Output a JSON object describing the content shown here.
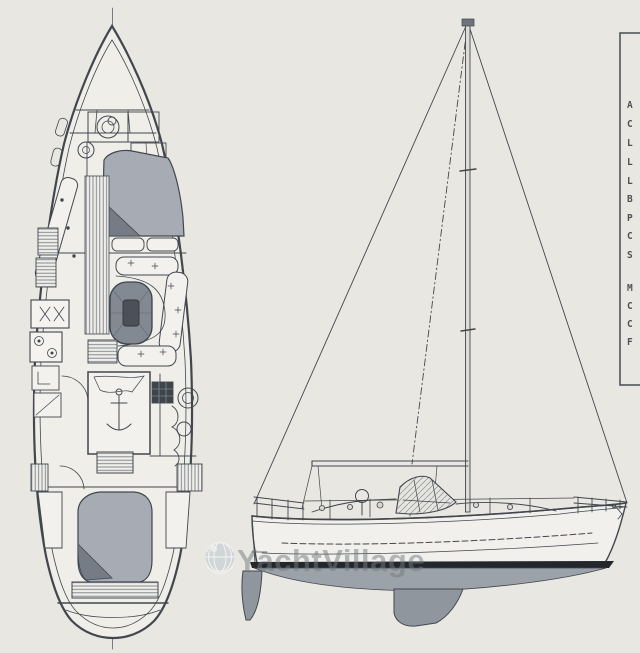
{
  "canvas": {
    "width": 640,
    "height": 653,
    "background": "#e9e7e1"
  },
  "palette": {
    "ink": "#42474e",
    "paper": "#efeee9",
    "berth_shade": "#a7acb4",
    "berth_fold": "#767c85",
    "table_fill": "#838993",
    "table_center": "#4b5158",
    "underwater_body": "#9ba2aa",
    "keel_rudder": "#8f969e",
    "waterline_band": "#23272c",
    "watermark_text_color": "rgba(116,121,126,0.5)",
    "globe_color": "#c3ccd2"
  },
  "watermark": {
    "text": "YachtVillage",
    "icon": "globe-icon"
  },
  "specs_panel": {
    "letters": [
      "A",
      "C",
      "L",
      "L",
      "L",
      "B",
      "P",
      "C",
      "S",
      "M",
      "C",
      "C",
      "F"
    ]
  }
}
